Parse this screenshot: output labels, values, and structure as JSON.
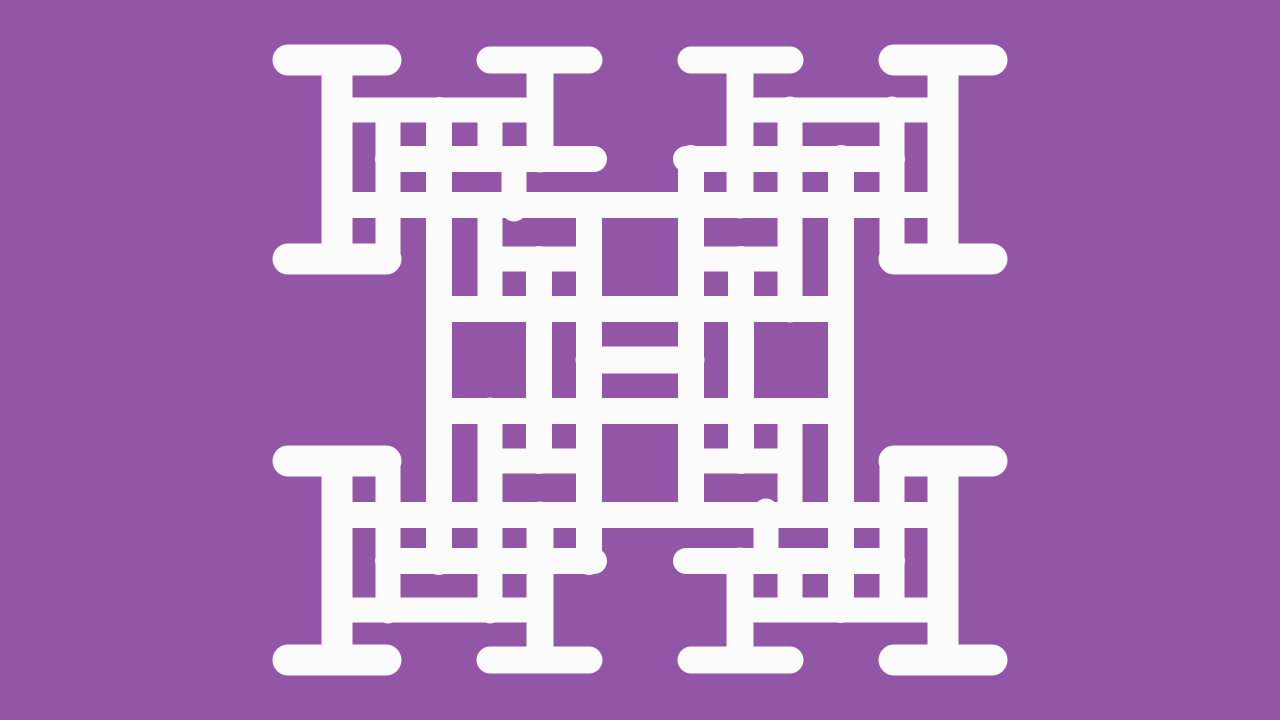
{
  "pattern": {
    "description": "abstract-fractal-lattice",
    "canvas": {
      "width": 1280,
      "height": 720
    },
    "colors": {
      "background": "#9355A5",
      "foreground": "#FCFBFC"
    },
    "symmetry": "rotate-180",
    "stroke_linecap": "round",
    "segments": [
      {
        "name": "corner-cap-top",
        "x1": 288,
        "y1": 60,
        "x2": 386,
        "y2": 60,
        "w": 31
      },
      {
        "name": "corner-stem",
        "x1": 337,
        "y1": 60,
        "x2": 337,
        "y2": 259,
        "w": 31
      },
      {
        "name": "corner-cap-bottom",
        "x1": 288,
        "y1": 259,
        "x2": 386,
        "y2": 259,
        "w": 31
      },
      {
        "name": "medium-cap-top",
        "x1": 490,
        "y1": 60,
        "x2": 589,
        "y2": 60,
        "w": 27
      },
      {
        "name": "medium-stem-short",
        "x1": 540,
        "y1": 60,
        "x2": 540,
        "y2": 159,
        "w": 27
      },
      {
        "name": "h-line-110",
        "x1": 337,
        "y1": 110,
        "x2": 540,
        "y2": 110,
        "w": 25
      },
      {
        "name": "h-line-159",
        "x1": 388,
        "y1": 159,
        "x2": 594,
        "y2": 159,
        "w": 26
      },
      {
        "name": "v-line-388-top",
        "x1": 388,
        "y1": 110,
        "x2": 388,
        "y2": 259,
        "w": 25
      },
      {
        "name": "v-line-439-long",
        "x1": 439,
        "y1": 110,
        "x2": 439,
        "y2": 562,
        "w": 26
      },
      {
        "name": "v-line-490-short",
        "x1": 490,
        "y1": 110,
        "x2": 490,
        "y2": 159,
        "w": 25
      },
      {
        "name": "v-line-490-mid",
        "x1": 490,
        "y1": 209,
        "x2": 490,
        "y2": 309,
        "w": 25
      },
      {
        "name": "v-line-514",
        "x1": 514,
        "y1": 159,
        "x2": 514,
        "y2": 209,
        "w": 25
      },
      {
        "name": "v-line-589-long",
        "x1": 589,
        "y1": 205,
        "x2": 589,
        "y2": 562,
        "w": 26
      },
      {
        "name": "v-line-490-bottom",
        "x1": 490,
        "y1": 410,
        "x2": 490,
        "y2": 611,
        "w": 25
      },
      {
        "name": "medium-stem-long",
        "x1": 540,
        "y1": 515,
        "x2": 540,
        "y2": 660,
        "w": 27
      },
      {
        "name": "v-line-388-bottom",
        "x1": 388,
        "y1": 461,
        "x2": 388,
        "y2": 611,
        "w": 25
      },
      {
        "name": "corner-stem-bl",
        "x1": 337,
        "y1": 461,
        "x2": 337,
        "y2": 660,
        "w": 31
      },
      {
        "name": "corner-cap-top-bl",
        "x1": 288,
        "y1": 461,
        "x2": 386,
        "y2": 461,
        "w": 31
      },
      {
        "name": "corner-cap-bottom-bl",
        "x1": 288,
        "y1": 660,
        "x2": 386,
        "y2": 660,
        "w": 31
      },
      {
        "name": "medium-cap-bottom",
        "x1": 490,
        "y1": 660,
        "x2": 589,
        "y2": 660,
        "w": 27
      },
      {
        "name": "h-line-561",
        "x1": 388,
        "y1": 561,
        "x2": 594,
        "y2": 561,
        "w": 26
      },
      {
        "name": "h-line-610",
        "x1": 337,
        "y1": 610,
        "x2": 540,
        "y2": 610,
        "w": 25
      },
      {
        "name": "h-line-259-mid",
        "x1": 490,
        "y1": 259,
        "x2": 589,
        "y2": 259,
        "w": 25
      },
      {
        "name": "h-line-461-mid",
        "x1": 490,
        "y1": 461,
        "x2": 589,
        "y2": 461,
        "w": 25
      },
      {
        "name": "v-line-539-mid",
        "x1": 539,
        "y1": 259,
        "x2": 539,
        "y2": 461,
        "w": 26
      },
      {
        "name": "long-line-top",
        "x1": 337,
        "y1": 205,
        "x2": 943,
        "y2": 205,
        "w": 26
      },
      {
        "name": "mid-line-309",
        "x1": 439,
        "y1": 309,
        "x2": 841,
        "y2": 309,
        "w": 26
      }
    ],
    "self_symmetric_segments": [
      {
        "name": "center-stem",
        "x1": 589,
        "y1": 360,
        "x2": 691,
        "y2": 360,
        "w": 27
      }
    ]
  }
}
